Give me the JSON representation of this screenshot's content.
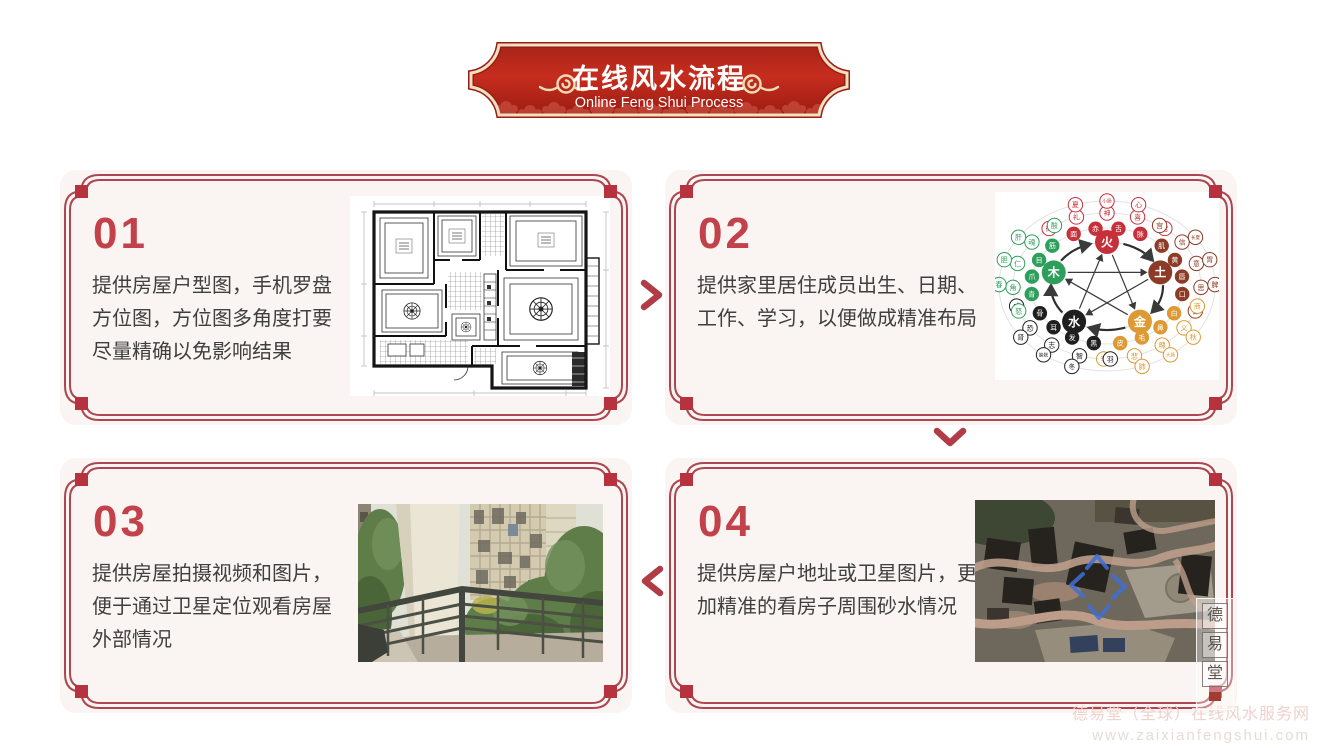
{
  "header": {
    "title": "在线风水流程",
    "subtitle": "Online Feng Shui Process"
  },
  "steps": [
    {
      "number": "01",
      "lines": [
        "提供房屋户型图，手机罗盘",
        "方位图，方位图多角度打要",
        "尽量精确以免影响结果"
      ],
      "image_name": "floor-plan-drawing"
    },
    {
      "number": "02",
      "lines": [
        "提供家里居住成员出生、日期、",
        "工作、学习，以便做成精准布局"
      ],
      "image_name": "five-elements-chart"
    },
    {
      "number": "03",
      "lines": [
        "提供房屋拍摄视频和图片，",
        "便于通过卫星定位观看房屋",
        "外部情况"
      ],
      "image_name": "balcony-photo"
    },
    {
      "number": "04",
      "lines": [
        "提供房屋户地址或卫星图片，更",
        "加精准的看房子周围砂水情况"
      ],
      "image_name": "satellite-photo"
    }
  ],
  "icons": {
    "flow_arrow_right": "chevron-right",
    "flow_arrow_down": "chevron-down",
    "flow_arrow_left": "chevron-left"
  },
  "five_elements_chart": {
    "type": "diagram",
    "elements": [
      {
        "label": "火",
        "color": "#c5303a",
        "angle": 90,
        "near": [
          "脉",
          "舌",
          "赤",
          "面"
        ],
        "mid": [
          "苦",
          "喜",
          "神",
          "礼",
          "徵"
        ],
        "far": [
          "心",
          "小肠",
          "夏"
        ]
      },
      {
        "label": "土",
        "color": "#8d3a26",
        "angle": 18,
        "near": [
          "口",
          "唇",
          "黄",
          "肌"
        ],
        "mid": [
          "甘",
          "思",
          "意",
          "信",
          "宫"
        ],
        "far": [
          "脾",
          "胃",
          "长夏"
        ]
      },
      {
        "label": "金",
        "color": "#dd9933",
        "angle": -54,
        "near": [
          "皮",
          "毛",
          "鼻",
          "白"
        ],
        "mid": [
          "辛",
          "悲",
          "魄",
          "义",
          "商"
        ],
        "far": [
          "肺",
          "大肠",
          "秋"
        ]
      },
      {
        "label": "水",
        "color": "#1f1f1f",
        "angle": -126,
        "near": [
          "骨",
          "耳",
          "发",
          "黑"
        ],
        "mid": [
          "咸",
          "恐",
          "志",
          "智",
          "羽"
        ],
        "far": [
          "肾",
          "膀胱",
          "冬"
        ]
      },
      {
        "label": "木",
        "color": "#2e9e5b",
        "angle": 162,
        "near": [
          "筋",
          "目",
          "爪",
          "青"
        ],
        "mid": [
          "酸",
          "魂",
          "仁",
          "角",
          "怒"
        ],
        "far": [
          "肝",
          "胆",
          "春"
        ]
      }
    ]
  },
  "seal": {
    "chars": [
      "德",
      "易",
      "堂"
    ]
  },
  "watermark": {
    "line1": "德易堂（全球）在线风水服务网",
    "line2": "www.zaixianfengshui.com"
  },
  "colors": {
    "banner_red": "#c02a1c",
    "banner_border": "#f1dfc0",
    "frame_red": "#ac4650",
    "corner_square_red": "#b5323e",
    "number_red": "#c2414a",
    "text_dark": "#3f3f3f",
    "card_bg": "#faf5f2"
  }
}
